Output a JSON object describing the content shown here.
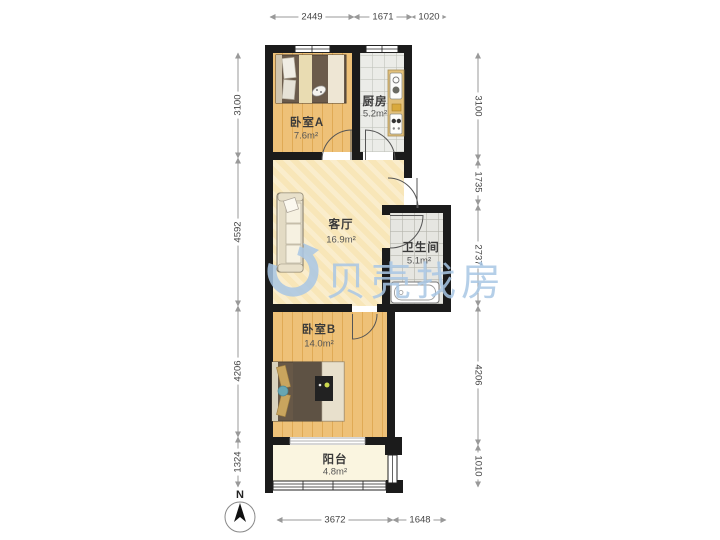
{
  "watermark": {
    "brand": "贝壳找房"
  },
  "compass": {
    "label": "N"
  },
  "rooms": {
    "bedroomA": {
      "name": "卧室A",
      "area": "7.6m²"
    },
    "kitchen": {
      "name": "厨房",
      "area": "5.2m²"
    },
    "living": {
      "name": "客厅",
      "area": "16.9m²"
    },
    "bathroom": {
      "name": "卫生间",
      "area": "5.1m²"
    },
    "bedroomB": {
      "name": "卧室B",
      "area": "14.0m²"
    },
    "balcony": {
      "name": "阳台",
      "area": "4.8m²"
    }
  },
  "dimensions": {
    "top": [
      "2449",
      "1671",
      "1020"
    ],
    "bottom": [
      "3672",
      "1648"
    ],
    "left": [
      "3100",
      "4592",
      "4206",
      "1324"
    ],
    "right": [
      "3100",
      "1735",
      "2737",
      "4206",
      "1010"
    ]
  },
  "colors": {
    "wall": "#1b1b1b",
    "wood_floor": "#eec178",
    "living_floor": "#f8e6b8",
    "tile_floor": "#ebece8",
    "balcony_floor": "#faf5e0",
    "watermark_blue": "#a9c7e5",
    "dimension_line": "#999999"
  }
}
